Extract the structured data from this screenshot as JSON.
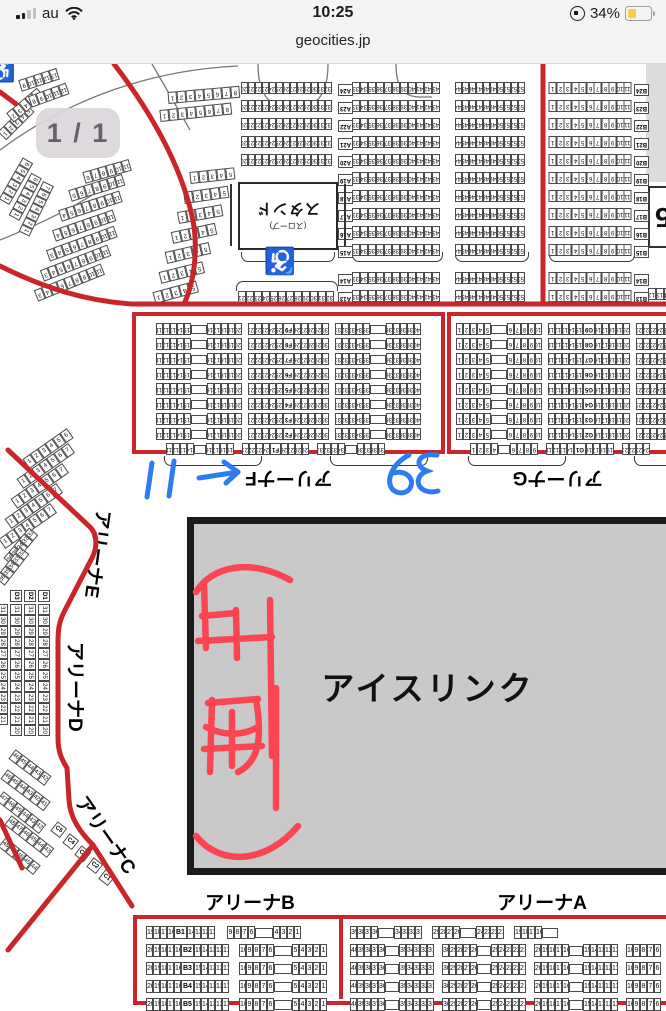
{
  "status_bar": {
    "carrier": "au",
    "time": "10:25",
    "battery_percent": "34%",
    "battery_color": "#F6CE45",
    "signal_bars_filled": 2,
    "signal_bars_total": 4
  },
  "url_bar": {
    "domain": "geocities.jp"
  },
  "page_indicator": {
    "label": "1 / 1"
  },
  "map": {
    "rink": {
      "label": "アイスリンク",
      "fill": "#c9c9c9"
    },
    "stand_box": {
      "label": "スタンド",
      "sublabel": "(スロープ)"
    },
    "edge_label": "5",
    "accessibility_glyph": "♿",
    "section_labels": {
      "a": "アリーナA",
      "b": "アリーナB",
      "c": "アリーナC",
      "d": "アリーナD",
      "e": "アリーナE",
      "f": "アリーナF",
      "g": "アリーナG"
    },
    "colors": {
      "boundary_red": "#c9262c",
      "rink_grey": "#c9c9c9"
    }
  },
  "annotations": {
    "blue_ink": {
      "color": "#2e7cf5",
      "items": [
        "11",
        "arrow-right",
        "39 (written upside-down)"
      ]
    },
    "red_ink": {
      "color": "#fb4553",
      "description": "hand-drawn characters with underline arc"
    }
  },
  "strips": [
    {
      "x": 241,
      "y": 82,
      "dy": 18,
      "rep": 5,
      "f": 1,
      "cw": 7,
      "seg": [
        [
          "n",
          20,
          32
        ]
      ]
    },
    {
      "x": 352,
      "y": 82,
      "dy": 18,
      "rep": 10,
      "f": 1,
      "cw": 8,
      "seg": [
        [
          "n",
          33,
          43
        ]
      ]
    },
    {
      "x": 455,
      "y": 82,
      "dy": 18,
      "rep": 10,
      "f": 1,
      "cw": 7,
      "seg": [
        [
          "n",
          44,
          53
        ]
      ]
    },
    {
      "x": 549,
      "y": 82,
      "dy": 18,
      "rep": 10,
      "f": 1,
      "cw": 7.5,
      "seg": [
        [
          "n",
          1,
          11
        ]
      ]
    },
    {
      "x": 352,
      "y": 272,
      "dy": 18,
      "rep": 2,
      "f": 1,
      "cw": 8,
      "seg": [
        [
          "n",
          33,
          43
        ]
      ]
    },
    {
      "x": 455,
      "y": 272,
      "dy": 18,
      "rep": 2,
      "f": 1,
      "cw": 7,
      "seg": [
        [
          "n",
          44,
          53
        ]
      ]
    },
    {
      "x": 549,
      "y": 272,
      "dy": 18,
      "rep": 2,
      "f": 1,
      "cw": 7.5,
      "seg": [
        [
          "n",
          1,
          11
        ]
      ]
    },
    {
      "x": 238,
      "y": 291,
      "f": 1,
      "cw": 8,
      "seg": [
        [
          "n",
          21,
          32
        ]
      ]
    },
    {
      "x": 634,
      "y": 84,
      "dy": 18,
      "rep": 10,
      "f": 1,
      "rl": [
        "B24",
        "B23",
        "B22",
        "B21",
        "B20",
        "B19",
        "B18",
        "B17",
        "B16",
        "B15"
      ],
      "seg": [
        [
          "rl"
        ]
      ]
    },
    {
      "x": 634,
      "y": 274,
      "dy": 18,
      "rep": 2,
      "f": 1,
      "rl": [
        "B14",
        "B13"
      ],
      "seg": [
        [
          "rl"
        ]
      ]
    },
    {
      "x": 338,
      "y": 84,
      "dy": 18,
      "rep": 10,
      "f": 1,
      "rl": [
        "A24",
        "A23",
        "A22",
        "A21",
        "A20",
        "A19",
        "A18",
        "A17",
        "A16",
        "A15"
      ],
      "seg": [
        [
          "rl"
        ]
      ]
    },
    {
      "x": 338,
      "y": 274,
      "dy": 18,
      "rep": 2,
      "f": 1,
      "rl": [
        "A14",
        "A13"
      ],
      "seg": [
        [
          "rl"
        ]
      ]
    },
    {
      "x": 168,
      "y": 92,
      "a": -5,
      "f": 1,
      "cw": 9,
      "seg": [
        [
          "n",
          1,
          8
        ]
      ]
    },
    {
      "x": 160,
      "y": 110,
      "a": -6,
      "f": 1,
      "cw": 9,
      "seg": [
        [
          "n",
          1,
          8
        ]
      ]
    },
    {
      "x": 190,
      "y": 172,
      "a": -6,
      "f": 1,
      "cw": 9,
      "seg": [
        [
          "n",
          1,
          5
        ]
      ]
    },
    {
      "x": 184,
      "y": 192,
      "a": -8,
      "f": 1,
      "cw": 9,
      "seg": [
        [
          "n",
          1,
          5
        ]
      ]
    },
    {
      "x": 178,
      "y": 212,
      "a": -10,
      "f": 1,
      "cw": 9,
      "seg": [
        [
          "n",
          1,
          5
        ]
      ]
    },
    {
      "x": 172,
      "y": 232,
      "a": -12,
      "f": 1,
      "cw": 9,
      "seg": [
        [
          "n",
          1,
          5
        ]
      ]
    },
    {
      "x": 166,
      "y": 252,
      "a": -13,
      "f": 1,
      "cw": 9,
      "seg": [
        [
          "n",
          1,
          5
        ]
      ]
    },
    {
      "x": 160,
      "y": 272,
      "a": -14,
      "f": 1,
      "cw": 9,
      "seg": [
        [
          "n",
          1,
          5
        ]
      ]
    },
    {
      "x": 154,
      "y": 292,
      "a": -15,
      "f": 1,
      "cw": 9,
      "seg": [
        [
          "n",
          1,
          5
        ]
      ]
    },
    {
      "x": 60,
      "y": 210,
      "a": -18,
      "f": 1,
      "cw": 8,
      "seg": [
        [
          "n",
          4,
          11
        ]
      ]
    },
    {
      "x": 54,
      "y": 230,
      "a": -19,
      "f": 1,
      "cw": 8,
      "seg": [
        [
          "n",
          4,
          11
        ]
      ]
    },
    {
      "x": 48,
      "y": 250,
      "a": -20,
      "f": 1,
      "cw": 8,
      "seg": [
        [
          "n",
          3,
          11
        ]
      ]
    },
    {
      "x": 42,
      "y": 270,
      "a": -21,
      "f": 1,
      "cw": 8,
      "seg": [
        [
          "n",
          3,
          11
        ]
      ]
    },
    {
      "x": 36,
      "y": 290,
      "a": -22,
      "f": 1,
      "cw": 8,
      "seg": [
        [
          "n",
          3,
          11
        ]
      ]
    },
    {
      "x": 70,
      "y": 190,
      "a": -17,
      "f": 1,
      "cw": 8,
      "seg": [
        [
          "n",
          5,
          11
        ]
      ]
    },
    {
      "x": 84,
      "y": 172,
      "a": -16,
      "f": 1,
      "cw": 8,
      "seg": [
        [
          "n",
          6,
          11
        ]
      ]
    },
    {
      "x": 4,
      "y": 196,
      "a": -60,
      "f": 1,
      "cw": 8,
      "seg": [
        [
          "n",
          1,
          6
        ]
      ]
    },
    {
      "x": 14,
      "y": 212,
      "a": -62,
      "f": 1,
      "cw": 8,
      "seg": [
        [
          "n",
          1,
          6
        ]
      ]
    },
    {
      "x": 24,
      "y": 228,
      "a": -64,
      "f": 1,
      "cw": 8,
      "seg": [
        [
          "n",
          1,
          7
        ]
      ]
    },
    {
      "x": 2,
      "y": 130,
      "a": -45,
      "f": 1,
      "cw": 8,
      "seg": [
        [
          "n",
          1,
          5
        ]
      ]
    },
    {
      "x": 10,
      "y": 112,
      "a": -40,
      "f": 1,
      "cw": 8,
      "seg": [
        [
          "n",
          2,
          6
        ]
      ]
    },
    {
      "x": 30,
      "y": 96,
      "a": -20,
      "f": 1,
      "cw": 8,
      "seg": [
        [
          "n",
          8,
          12
        ]
      ]
    },
    {
      "x": 20,
      "y": 80,
      "a": -18,
      "f": 1,
      "cw": 8,
      "seg": [
        [
          "n",
          9,
          13
        ]
      ]
    },
    {
      "x": 648,
      "y": 288,
      "f": 1,
      "cw": 8,
      "seg": [
        [
          "n",
          12,
          14
        ]
      ]
    },
    {
      "x": 156,
      "y": 323,
      "dy": 15,
      "rep": 8,
      "f": 1,
      "cw": 7,
      "rl": [
        "F9",
        "F8",
        "F7",
        "F6",
        "F5",
        "F4",
        "F3",
        "F2"
      ],
      "seg": [
        [
          "n",
          11,
          15
        ],
        [
          "b",
          16
        ],
        [
          "n",
          16,
          20
        ],
        [
          "s",
          6
        ],
        [
          "n",
          21,
          25
        ],
        [
          "rl"
        ],
        [
          "n",
          26,
          30
        ],
        [
          "s",
          6
        ],
        [
          "n",
          31,
          35
        ],
        [
          "b",
          16
        ],
        [
          "n",
          36,
          40
        ]
      ]
    },
    {
      "x": 166,
      "y": 443,
      "f": 1,
      "cw": 7,
      "rl": [
        "F1"
      ],
      "seg": [
        [
          "n",
          11,
          14
        ],
        [
          "b",
          12
        ],
        [
          "n",
          16,
          19
        ],
        [
          "s",
          8
        ],
        [
          "n",
          21,
          24
        ],
        [
          "rl"
        ],
        [
          "n",
          26,
          29
        ],
        [
          "s",
          8
        ],
        [
          "n",
          31,
          34
        ],
        [
          "b",
          12
        ],
        [
          "n",
          36,
          39
        ]
      ]
    },
    {
      "x": 456,
      "y": 323,
      "dy": 15,
      "rep": 8,
      "f": 1,
      "cw": 7,
      "rl": [
        "G9",
        "G8",
        "G7",
        "G6",
        "G5",
        "G4",
        "G3",
        "G2"
      ],
      "seg": [
        [
          "n",
          1,
          5
        ],
        [
          "b",
          16
        ],
        [
          "n",
          6,
          10
        ],
        [
          "s",
          6
        ],
        [
          "n",
          11,
          15
        ],
        [
          "rl"
        ],
        [
          "n",
          16,
          20
        ],
        [
          "s",
          6
        ],
        [
          "n",
          21,
          25
        ],
        [
          "b",
          16
        ],
        [
          "n",
          26,
          30
        ]
      ]
    },
    {
      "x": 470,
      "y": 443,
      "f": 1,
      "cw": 7,
      "rl": [
        "G1"
      ],
      "seg": [
        [
          "n",
          1,
          4
        ],
        [
          "b",
          12
        ],
        [
          "n",
          6,
          9
        ],
        [
          "s",
          8
        ],
        [
          "n",
          11,
          14
        ],
        [
          "rl"
        ],
        [
          "n",
          16,
          19
        ],
        [
          "s",
          8
        ],
        [
          "n",
          21,
          24
        ]
      ]
    },
    {
      "x": 26,
      "y": 458,
      "a": -35,
      "cw": 9,
      "seg": [
        [
          "n",
          1,
          6
        ]
      ]
    },
    {
      "x": 20,
      "y": 478,
      "a": -35,
      "cw": 9,
      "seg": [
        [
          "n",
          1,
          7
        ]
      ]
    },
    {
      "x": 14,
      "y": 498,
      "a": -35,
      "cw": 9,
      "seg": [
        [
          "n",
          1,
          7
        ]
      ]
    },
    {
      "x": 8,
      "y": 518,
      "a": -35,
      "cw": 9,
      "seg": [
        [
          "n",
          1,
          7
        ]
      ]
    },
    {
      "x": 2,
      "y": 538,
      "a": -35,
      "cw": 9,
      "seg": [
        [
          "n",
          1,
          7
        ]
      ]
    },
    {
      "x": 8,
      "y": 556,
      "a": -50,
      "cw": 8,
      "seg": [
        [
          "n",
          36,
          32
        ]
      ]
    },
    {
      "x": 0,
      "y": 576,
      "a": -52,
      "cw": 8,
      "seg": [
        [
          "n",
          36,
          32
        ]
      ]
    },
    {
      "x": 16,
      "y": 584,
      "a": 90,
      "seg": [
        [
          "l",
          "D3"
        ]
      ]
    },
    {
      "x": 30,
      "y": 584,
      "a": 90,
      "seg": [
        [
          "l",
          "D2"
        ]
      ]
    },
    {
      "x": 44,
      "y": 584,
      "a": 90,
      "seg": [
        [
          "l",
          "D1"
        ]
      ]
    },
    {
      "x": 2,
      "y": 598,
      "a": 90,
      "cw": 11,
      "seg": [
        [
          "n",
          31,
          21
        ]
      ]
    },
    {
      "x": 16,
      "y": 598,
      "a": 90,
      "cw": 11,
      "seg": [
        [
          "n",
          31,
          20
        ]
      ]
    },
    {
      "x": 30,
      "y": 598,
      "a": 90,
      "cw": 11,
      "seg": [
        [
          "n",
          31,
          20
        ]
      ]
    },
    {
      "x": 44,
      "y": 598,
      "a": 90,
      "cw": 11,
      "seg": [
        [
          "n",
          31,
          20
        ]
      ]
    },
    {
      "x": 12,
      "y": 748,
      "a": 37,
      "cw": 9,
      "seg": [
        [
          "n",
          46,
          42
        ]
      ]
    },
    {
      "x": 4,
      "y": 768,
      "a": 37,
      "cw": 9,
      "seg": [
        [
          "n",
          46,
          41
        ]
      ]
    },
    {
      "x": 0,
      "y": 790,
      "a": 38,
      "cw": 9,
      "seg": [
        [
          "n",
          47,
          42
        ]
      ]
    },
    {
      "x": 8,
      "y": 814,
      "a": 38,
      "cw": 9,
      "seg": [
        [
          "n",
          48,
          43
        ]
      ]
    },
    {
      "x": 2,
      "y": 836,
      "a": 39,
      "cw": 9,
      "seg": [
        [
          "n",
          48,
          44
        ]
      ]
    },
    {
      "x": 54,
      "y": 820,
      "a": 38,
      "seg": [
        [
          "l",
          "C5"
        ]
      ]
    },
    {
      "x": 66,
      "y": 832,
      "a": 38,
      "seg": [
        [
          "l",
          "C4"
        ]
      ]
    },
    {
      "x": 78,
      "y": 844,
      "a": 38,
      "seg": [
        [
          "l",
          "C3"
        ]
      ]
    },
    {
      "x": 90,
      "y": 856,
      "a": 38,
      "seg": [
        [
          "l",
          "C2"
        ]
      ]
    },
    {
      "x": 102,
      "y": 868,
      "a": 38,
      "seg": [
        [
          "l",
          "C1"
        ]
      ]
    },
    {
      "x": 146,
      "y": 926,
      "cw": 7,
      "ch": 13,
      "fs": 7,
      "seg": [
        [
          "n",
          19,
          16
        ],
        [
          "l",
          "B1"
        ],
        [
          "n",
          14,
          11
        ],
        [
          "s",
          12
        ],
        [
          "n",
          9,
          6
        ],
        [
          "b",
          18
        ],
        [
          "n",
          4,
          1
        ]
      ]
    },
    {
      "x": 146,
      "y": 944,
      "dy": 18,
      "rep": 4,
      "cw": 7,
      "ch": 13,
      "fs": 7,
      "rl": [
        "B2",
        "B3",
        "B4",
        "B5"
      ],
      "seg": [
        [
          "n",
          20,
          16
        ],
        [
          "rl"
        ],
        [
          "n",
          15,
          11
        ],
        [
          "s",
          10
        ],
        [
          "n",
          10,
          6
        ],
        [
          "b",
          18
        ],
        [
          "n",
          5,
          1
        ]
      ]
    },
    {
      "x": 350,
      "y": 926,
      "cw": 7,
      "ch": 13,
      "fs": 7,
      "seg": [
        [
          "n",
          39,
          36
        ],
        [
          "b",
          16
        ],
        [
          "n",
          34,
          31
        ],
        [
          "s",
          10
        ],
        [
          "n",
          29,
          26
        ],
        [
          "b",
          16
        ],
        [
          "n",
          24,
          21
        ],
        [
          "s",
          10
        ],
        [
          "n",
          19,
          16
        ],
        [
          "b",
          16
        ]
      ]
    },
    {
      "x": 350,
      "y": 944,
      "dy": 18,
      "rep": 4,
      "cw": 7,
      "ch": 13,
      "fs": 7,
      "seg": [
        [
          "n",
          40,
          36
        ],
        [
          "b",
          14
        ],
        [
          "n",
          35,
          31
        ],
        [
          "s",
          8
        ],
        [
          "n",
          30,
          26
        ],
        [
          "b",
          14
        ],
        [
          "n",
          25,
          21
        ],
        [
          "s",
          8
        ],
        [
          "n",
          20,
          16
        ],
        [
          "b",
          14
        ],
        [
          "n",
          15,
          11
        ],
        [
          "s",
          8
        ],
        [
          "n",
          10,
          6
        ]
      ]
    }
  ],
  "brackets": [
    {
      "x": 241,
      "y": 252,
      "w": 92
    },
    {
      "x": 352,
      "y": 252,
      "w": 89
    },
    {
      "x": 455,
      "y": 252,
      "w": 72
    },
    {
      "x": 549,
      "y": 252,
      "w": 84
    },
    {
      "x": 236,
      "y": 281,
      "w": 100,
      "top": 1
    },
    {
      "x": 164,
      "y": 456,
      "w": 96
    },
    {
      "x": 330,
      "y": 456,
      "w": 96
    },
    {
      "x": 468,
      "y": 456,
      "w": 96
    },
    {
      "x": 634,
      "y": 456,
      "w": 60
    }
  ]
}
